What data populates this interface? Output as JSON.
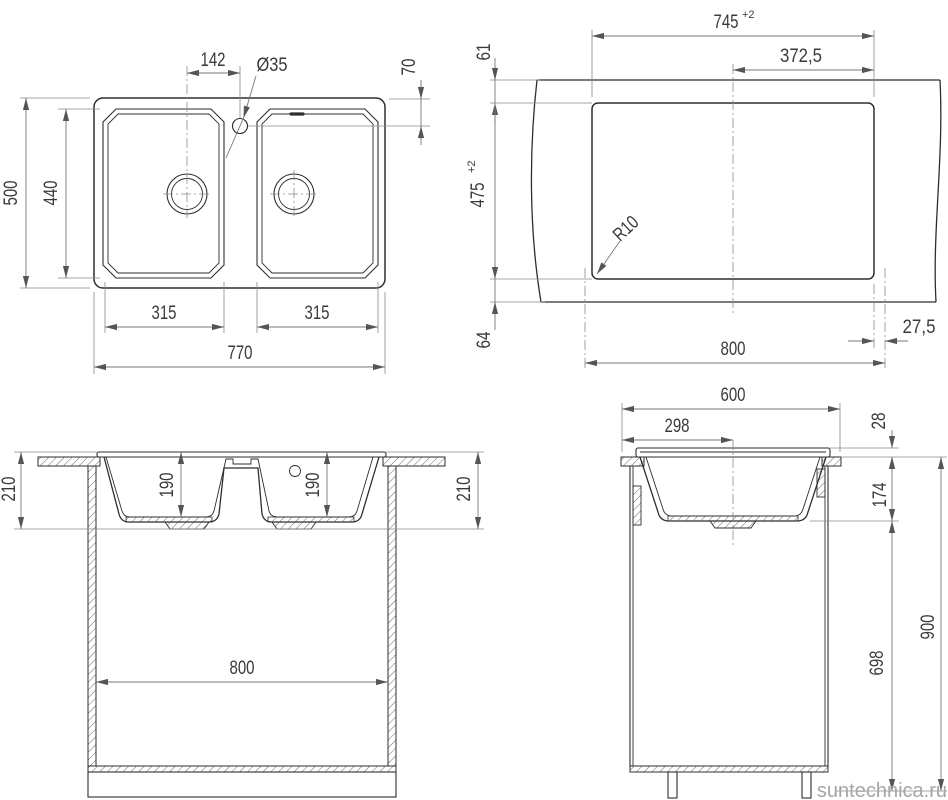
{
  "watermark": "suntechnica.ru",
  "top_view": {
    "overall_width": "770",
    "overall_depth": "500",
    "bowls_depth": "440",
    "left_bowl_width": "315",
    "right_bowl_width": "315",
    "faucet_offset": "142",
    "faucet_hole_diameter": "Ø35",
    "faucet_edge_offset": "70"
  },
  "cutout_view": {
    "cutout_width": "745",
    "cutout_width_tolerance": "+2",
    "cutout_half_width": "372,5",
    "top_margin": "61",
    "cutout_depth": "475",
    "cutout_depth_tolerance": "+2",
    "bottom_margin": "64",
    "cabinet_width": "800",
    "side_offset": "27,5",
    "corner_radius": "R10"
  },
  "front_view": {
    "sink_height_left": "210",
    "left_bowl_depth": "190",
    "right_bowl_depth": "190",
    "cabinet_inner_width": "800",
    "sink_height_right": "210"
  },
  "side_view": {
    "countertop_depth": "600",
    "drain_center_offset": "298",
    "rim_height": "28",
    "bowl_depth_below_top": "174",
    "under_bowl_clearance": "698",
    "cabinet_total_height": "900"
  }
}
